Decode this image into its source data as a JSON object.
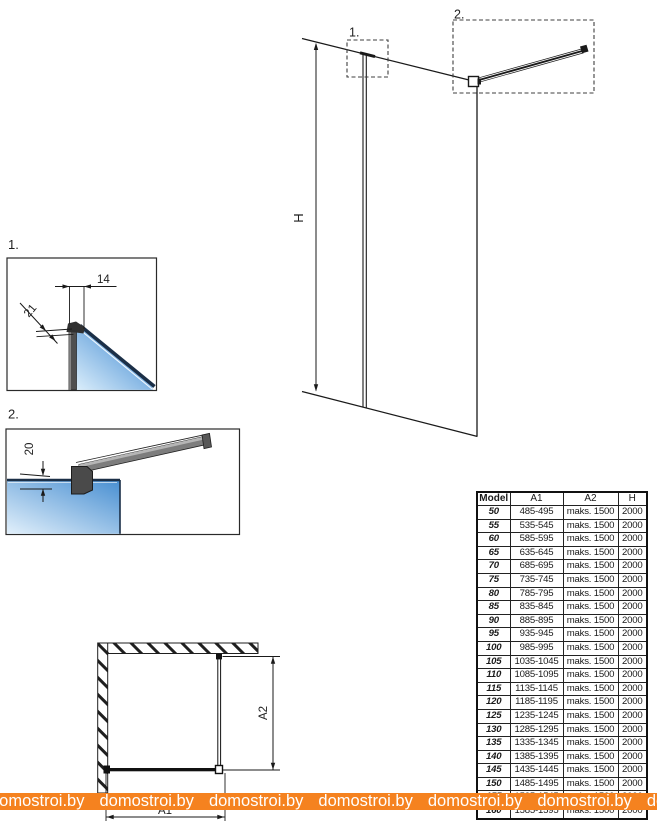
{
  "main_diagram": {
    "callout1_label": "1.",
    "callout2_label": "2.",
    "height_label": "H"
  },
  "detail1": {
    "label": "1.",
    "dim_top": "14",
    "dim_diagonal": "21"
  },
  "detail2": {
    "label": "2.",
    "dim_gap": "20"
  },
  "top_view": {
    "dim_width": "A1",
    "dim_depth": "A2"
  },
  "table": {
    "headers": [
      "Model",
      "A1",
      "A2",
      "H"
    ],
    "rows": [
      [
        "50",
        "485-495",
        "maks. 1500",
        "2000"
      ],
      [
        "55",
        "535-545",
        "maks. 1500",
        "2000"
      ],
      [
        "60",
        "585-595",
        "maks. 1500",
        "2000"
      ],
      [
        "65",
        "635-645",
        "maks. 1500",
        "2000"
      ],
      [
        "70",
        "685-695",
        "maks. 1500",
        "2000"
      ],
      [
        "75",
        "735-745",
        "maks. 1500",
        "2000"
      ],
      [
        "80",
        "785-795",
        "maks. 1500",
        "2000"
      ],
      [
        "85",
        "835-845",
        "maks. 1500",
        "2000"
      ],
      [
        "90",
        "885-895",
        "maks. 1500",
        "2000"
      ],
      [
        "95",
        "935-945",
        "maks. 1500",
        "2000"
      ],
      [
        "100",
        "985-995",
        "maks. 1500",
        "2000"
      ],
      [
        "105",
        "1035-1045",
        "maks. 1500",
        "2000"
      ],
      [
        "110",
        "1085-1095",
        "maks. 1500",
        "2000"
      ],
      [
        "115",
        "1135-1145",
        "maks. 1500",
        "2000"
      ],
      [
        "120",
        "1185-1195",
        "maks. 1500",
        "2000"
      ],
      [
        "125",
        "1235-1245",
        "maks. 1500",
        "2000"
      ],
      [
        "130",
        "1285-1295",
        "maks. 1500",
        "2000"
      ],
      [
        "135",
        "1335-1345",
        "maks. 1500",
        "2000"
      ],
      [
        "140",
        "1385-1395",
        "maks. 1500",
        "2000"
      ],
      [
        "145",
        "1435-1445",
        "maks. 1500",
        "2000"
      ],
      [
        "150",
        "1485-1495",
        "maks. 1500",
        "2000"
      ],
      [
        "155",
        "1535-1545",
        "maks. 1500",
        "2000"
      ],
      [
        "160",
        "1585-1595",
        "maks. 1500",
        "2000"
      ]
    ]
  },
  "watermark": {
    "text": "domostroi.by"
  },
  "colors": {
    "watermark_bg": "#F5821F",
    "watermark_text": "#ffffff",
    "line": "#1a1a1a",
    "glass_dark": "#4a90d4",
    "glass_light": "#dbeefb",
    "glass_edge": "#1b2f47",
    "profile_gray": "#4f4f4f"
  }
}
